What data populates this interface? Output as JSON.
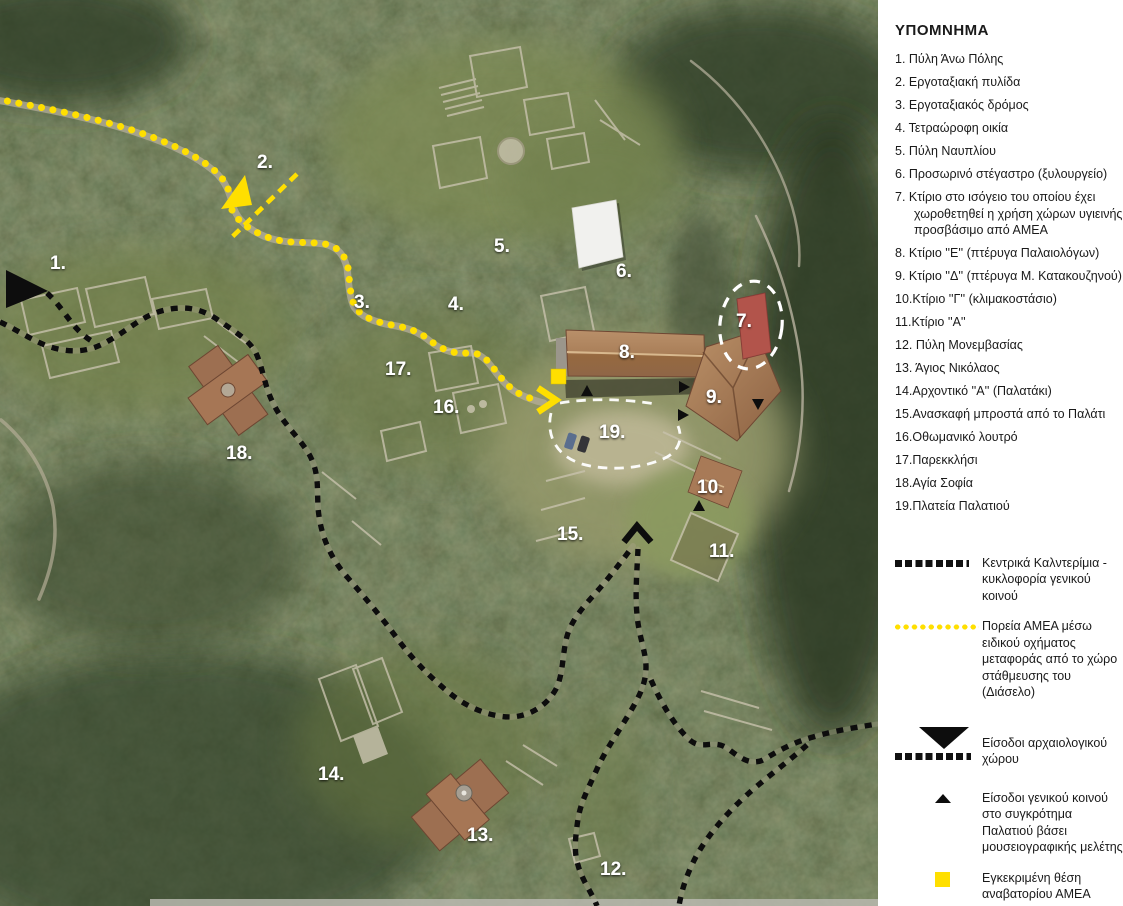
{
  "map": {
    "labels": [
      "1.",
      "2.",
      "3.",
      "4.",
      "5.",
      "6.",
      "7.",
      "8.",
      "9.",
      "10.",
      "11.",
      "12.",
      "13.",
      "14.",
      "15.",
      "16.",
      "17.",
      "18.",
      "19."
    ],
    "colors": {
      "amea_yellow": "#FFDF00",
      "route_black": "#0D0D0D",
      "dash_white": "#FFFFFF",
      "forest_green": "#44522F",
      "roof_terracotta": "#9A6F4D"
    }
  },
  "legend": {
    "title": "ΥΠΟΜΝΗΜΑ",
    "items": [
      "1. Πύλη Άνω Πόλης",
      "2. Εργοταξιακή πυλίδα",
      "3. Εργοταξιακός δρόμος",
      "4. Τετραώροφη οικία",
      "5. Πύλη Ναυπλίου",
      "6. Προσωρινό στέγαστρο (ξυλουργείο)",
      "7. Κτίριο  στο ισόγειο του οποίου έχει χωροθετηθεί η χρήση χώρων υγιεινής προσβάσιμο από ΑΜΕΑ",
      "8. Κτίριο ''Ε'' (πτέρυγα Παλαιολόγων)",
      "9. Κτίριο ''Δ'' (πτέρυγα Μ. Κατακουζηνού)",
      "10.Κτίριο ''Γ'' (κλιμακοστάσιο)",
      "11.Κτίριο ''Α''",
      "12. Πύλη Μονεμβασίας",
      "13. Άγιος Νικόλαος",
      "14.Αρχοντικό ''Α'' (Παλατάκι)",
      "15.Ανασκαφή μπροστά από το Παλάτι",
      "16.Οθωμανικό λουτρό",
      "17.Παρεκκλήσι",
      "18.Αγία Σοφία",
      "19.Πλατεία Παλατιού"
    ],
    "symbols": [
      {
        "name": "public-kalderimi-dashed-line",
        "text": "Κεντρικά Καλντερίμια - κυκλοφορία γενικού κοινού"
      },
      {
        "name": "amea-route-yellow-dots",
        "text": "Πορεία ΑΜΕΑ μέσω ειδικού οχήματος μεταφοράς από το χώρο στάθμευσης του (Διάσελο)"
      },
      {
        "name": "site-entrance-triangle",
        "text": "Είσοδοι αρχαιολογικού χώρου"
      },
      {
        "name": "palace-entrance-small-triangle",
        "text": "Είσοδοι γενικού κοινού στο συγκρότημα Παλατιού βάσει μουσειογραφικής μελέτης"
      },
      {
        "name": "amea-lift-yellow-square",
        "text": "Εγκεκριμένη θέση αναβατορίου ΑΜΕΑ"
      }
    ]
  }
}
